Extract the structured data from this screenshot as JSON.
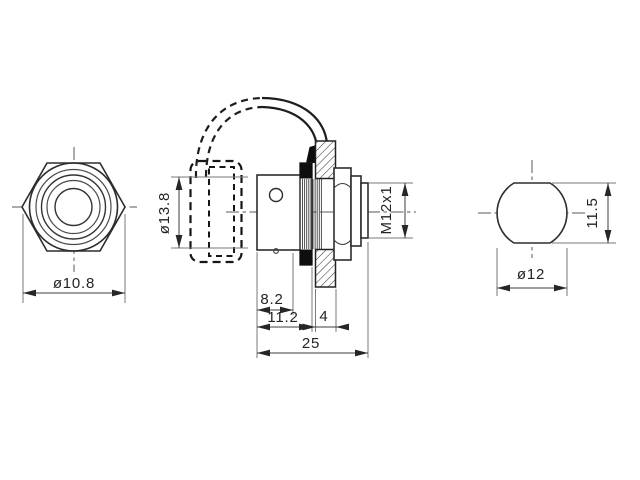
{
  "colors": {
    "background": "#ffffff",
    "line": "#2d2d2d",
    "thin_line": "#7a7a7a",
    "solid_fill": "#0e0e0e"
  },
  "views": {
    "front": {
      "label_diameter": "ø10.8"
    },
    "side": {
      "label_cap_diameter": "ø13.8",
      "label_thread": "M12x1",
      "label_len_8_2": "8.2",
      "label_len_11_2": "11.2",
      "label_panel_4": "4",
      "label_total_25": "25"
    },
    "end": {
      "label_diameter": "ø12",
      "label_height": "11.5"
    }
  }
}
